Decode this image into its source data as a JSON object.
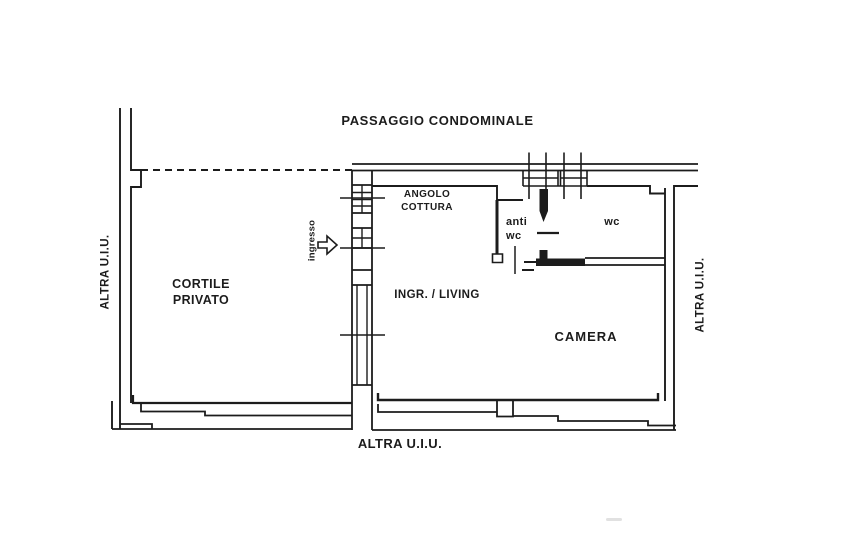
{
  "plan": {
    "colors": {
      "ink": "#1c1c1c",
      "paper": "#ffffff"
    },
    "labels": {
      "passaggio": "PASSAGGIO CONDOMINALE",
      "altra_left": "ALTRA U.I.U.",
      "altra_right": "ALTRA U.I.U.",
      "altra_bottom": "ALTRA U.I.U.",
      "cortile_line1": "CORTILE",
      "cortile_line2": "PRIVATO",
      "ingresso": "ingresso",
      "angolo_line1": "ANGOLO",
      "angolo_line2": "COTTURA",
      "ingr_living": "INGR. / LIVING",
      "anti_line1": "anti",
      "anti_line2": "wc",
      "wc": "wc",
      "camera": "CAMERA"
    }
  }
}
